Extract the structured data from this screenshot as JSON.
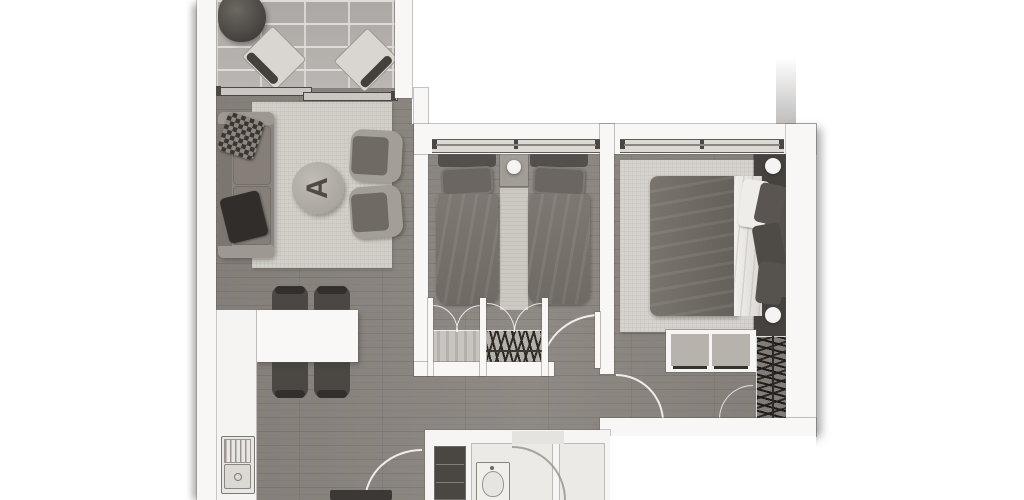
{
  "document": {
    "type": "apartment-floor-plan",
    "style": "top-down 2D rendered plan, grayscale, no text labels",
    "coffee_table_monogram": "A"
  },
  "palette": {
    "background": "#ffffff",
    "wall_white": "#f8f7f5",
    "wall_outline": "#6b6762",
    "wood_floor": "#8b8580",
    "balcony_tile": "#b6b2ae",
    "tile_grout": "#dedbd8",
    "rug_light": "#d2cfc9",
    "bathroom_floor": "#eceae7",
    "sofa_gray": "#8a8580",
    "dark_furniture": "#4b4743",
    "bed_blanket": "#716c66",
    "sheet_white": "#f2f0ed",
    "hanger_marks": "#1f1d1b",
    "shadow": "#69645f"
  },
  "rooms": [
    {
      "name": "balcony",
      "furniture": [
        "potted-plant",
        "lounge-chair",
        "lounge-chair",
        "sliding-glass-door"
      ]
    },
    {
      "name": "living-room",
      "furniture": [
        "sofa",
        "throw-pillow",
        "throw-pillow",
        "area-rug",
        "round-coffee-table",
        "armchair",
        "armchair"
      ]
    },
    {
      "name": "dining-area",
      "furniture": [
        "dining-table",
        "dining-chair",
        "dining-chair",
        "dining-chair",
        "dining-chair"
      ]
    },
    {
      "name": "kitchen",
      "furniture": [
        "counter",
        "double-basin-sink"
      ]
    },
    {
      "name": "twin-bedroom",
      "furniture": [
        "single-bed",
        "single-bed",
        "nightstand",
        "table-lamp",
        "runner-rug",
        "shelved-closet",
        "hanging-wardrobe",
        "window",
        "door-swing"
      ]
    },
    {
      "name": "master-bedroom",
      "furniture": [
        "double-bed",
        "headboard",
        "nightstand",
        "nightstand",
        "table-lamp",
        "table-lamp",
        "area-rug",
        "dresser",
        "hanging-wardrobe",
        "window",
        "door-swing"
      ]
    },
    {
      "name": "bathroom",
      "furniture": [
        "washbasin",
        "refrigerator-cabinet",
        "door-swing"
      ]
    },
    {
      "name": "hallway",
      "furniture": [
        "entry-door-swing",
        "shoe-cabinet"
      ]
    }
  ]
}
